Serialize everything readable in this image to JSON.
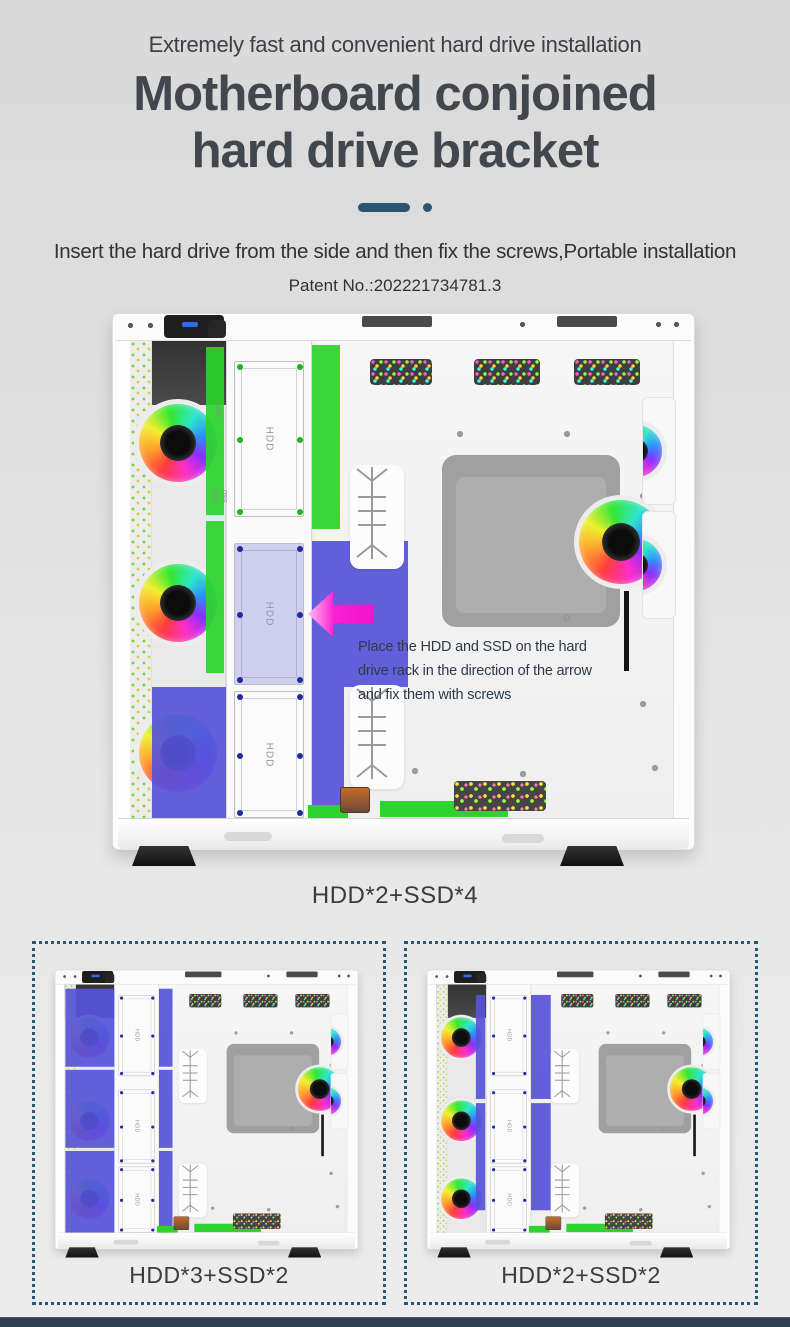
{
  "header": {
    "tagline": "Extremely fast and convenient hard drive installation",
    "title_line1": "Motherboard conjoined",
    "title_line2": "hard drive bracket",
    "description": "Insert the hard drive from the side and then fix the screws,Portable installation",
    "patent": "Patent No.:202221734781.3"
  },
  "main_figure": {
    "caption": "HDD*2+SSD*4",
    "annotation": [
      "Place the HDD and SSD on the hard",
      "drive rack in the direction of the arrow",
      "and fix them with screws"
    ]
  },
  "variants": [
    {
      "caption": "HDD*3+SSD*2"
    },
    {
      "caption": "HDD*2+SSD*2"
    }
  ],
  "labels": {
    "bay": "HDD",
    "hdd": "HDD",
    "ssd": "SSD"
  },
  "colors": {
    "highlight_green": "#2dd42d",
    "highlight_blue": "#5753d9",
    "bay_lavender": "#cfcfef",
    "arrow_pink": "#f512cd",
    "divider_blue": "#2a5673",
    "dotted_border": "#2b5777",
    "bottom_bar": "#2c3e50",
    "title_color": "#42474e",
    "annotation_color": "#2e3a4a"
  }
}
